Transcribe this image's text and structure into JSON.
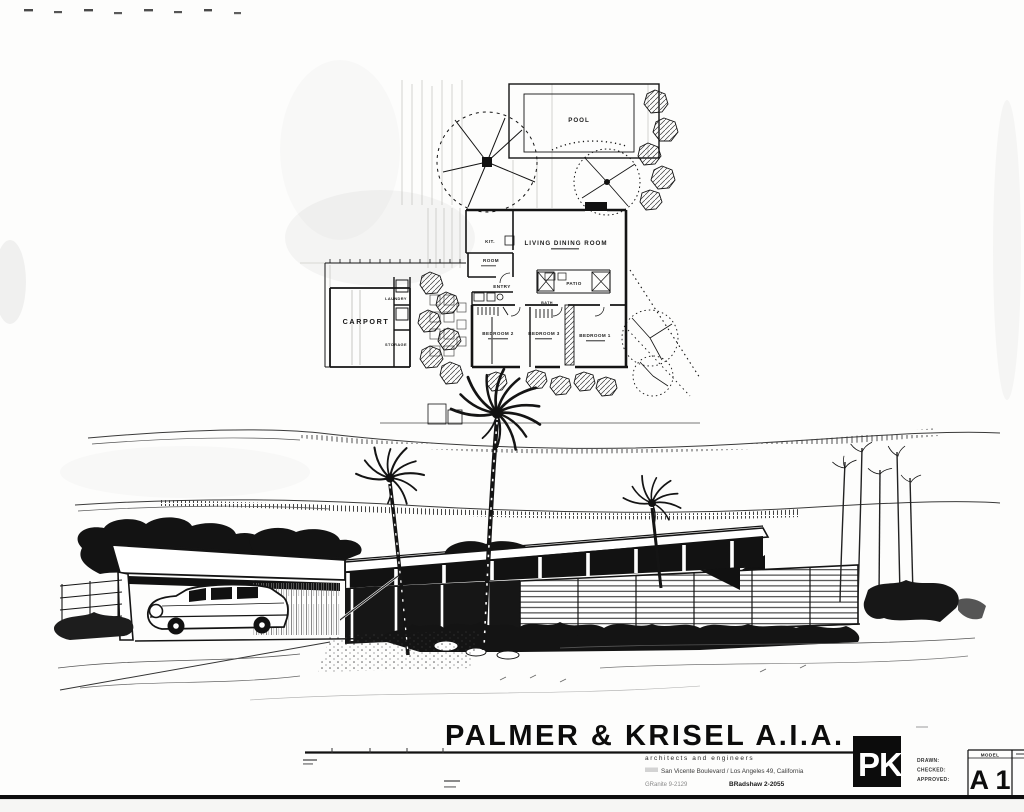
{
  "sheet": {
    "firm": {
      "title": "PALMER & KRISEL A.I.A.",
      "logo": "PK",
      "subtitle": "architects and engineers",
      "address": "San Vicente Boulevard  /  Los Angeles 49, California",
      "phone_left": "GRanite 9-2129",
      "phone_right": "BRadshaw 2-2055"
    },
    "title_block": {
      "drawn": "DRAWN:",
      "checked": "CHECKED:",
      "approved": "APPROVED:",
      "model": "MODEL",
      "sheet_no": "A 1"
    },
    "plan": {
      "pool": "POOL",
      "living_dining": "LIVING  DINING  ROOM",
      "kitchen": "KIT.",
      "room": "ROOM",
      "entry": "ENTRY",
      "patio": "PATIO",
      "carport": "CARPORT",
      "laundry": "LAUNDRY",
      "storage": "STORAGE",
      "bath": "BATH",
      "bedroom1": "BEDROOM 1",
      "bedroom2": "BEDROOM 2",
      "bedroom3": "BEDROOM 3"
    }
  }
}
